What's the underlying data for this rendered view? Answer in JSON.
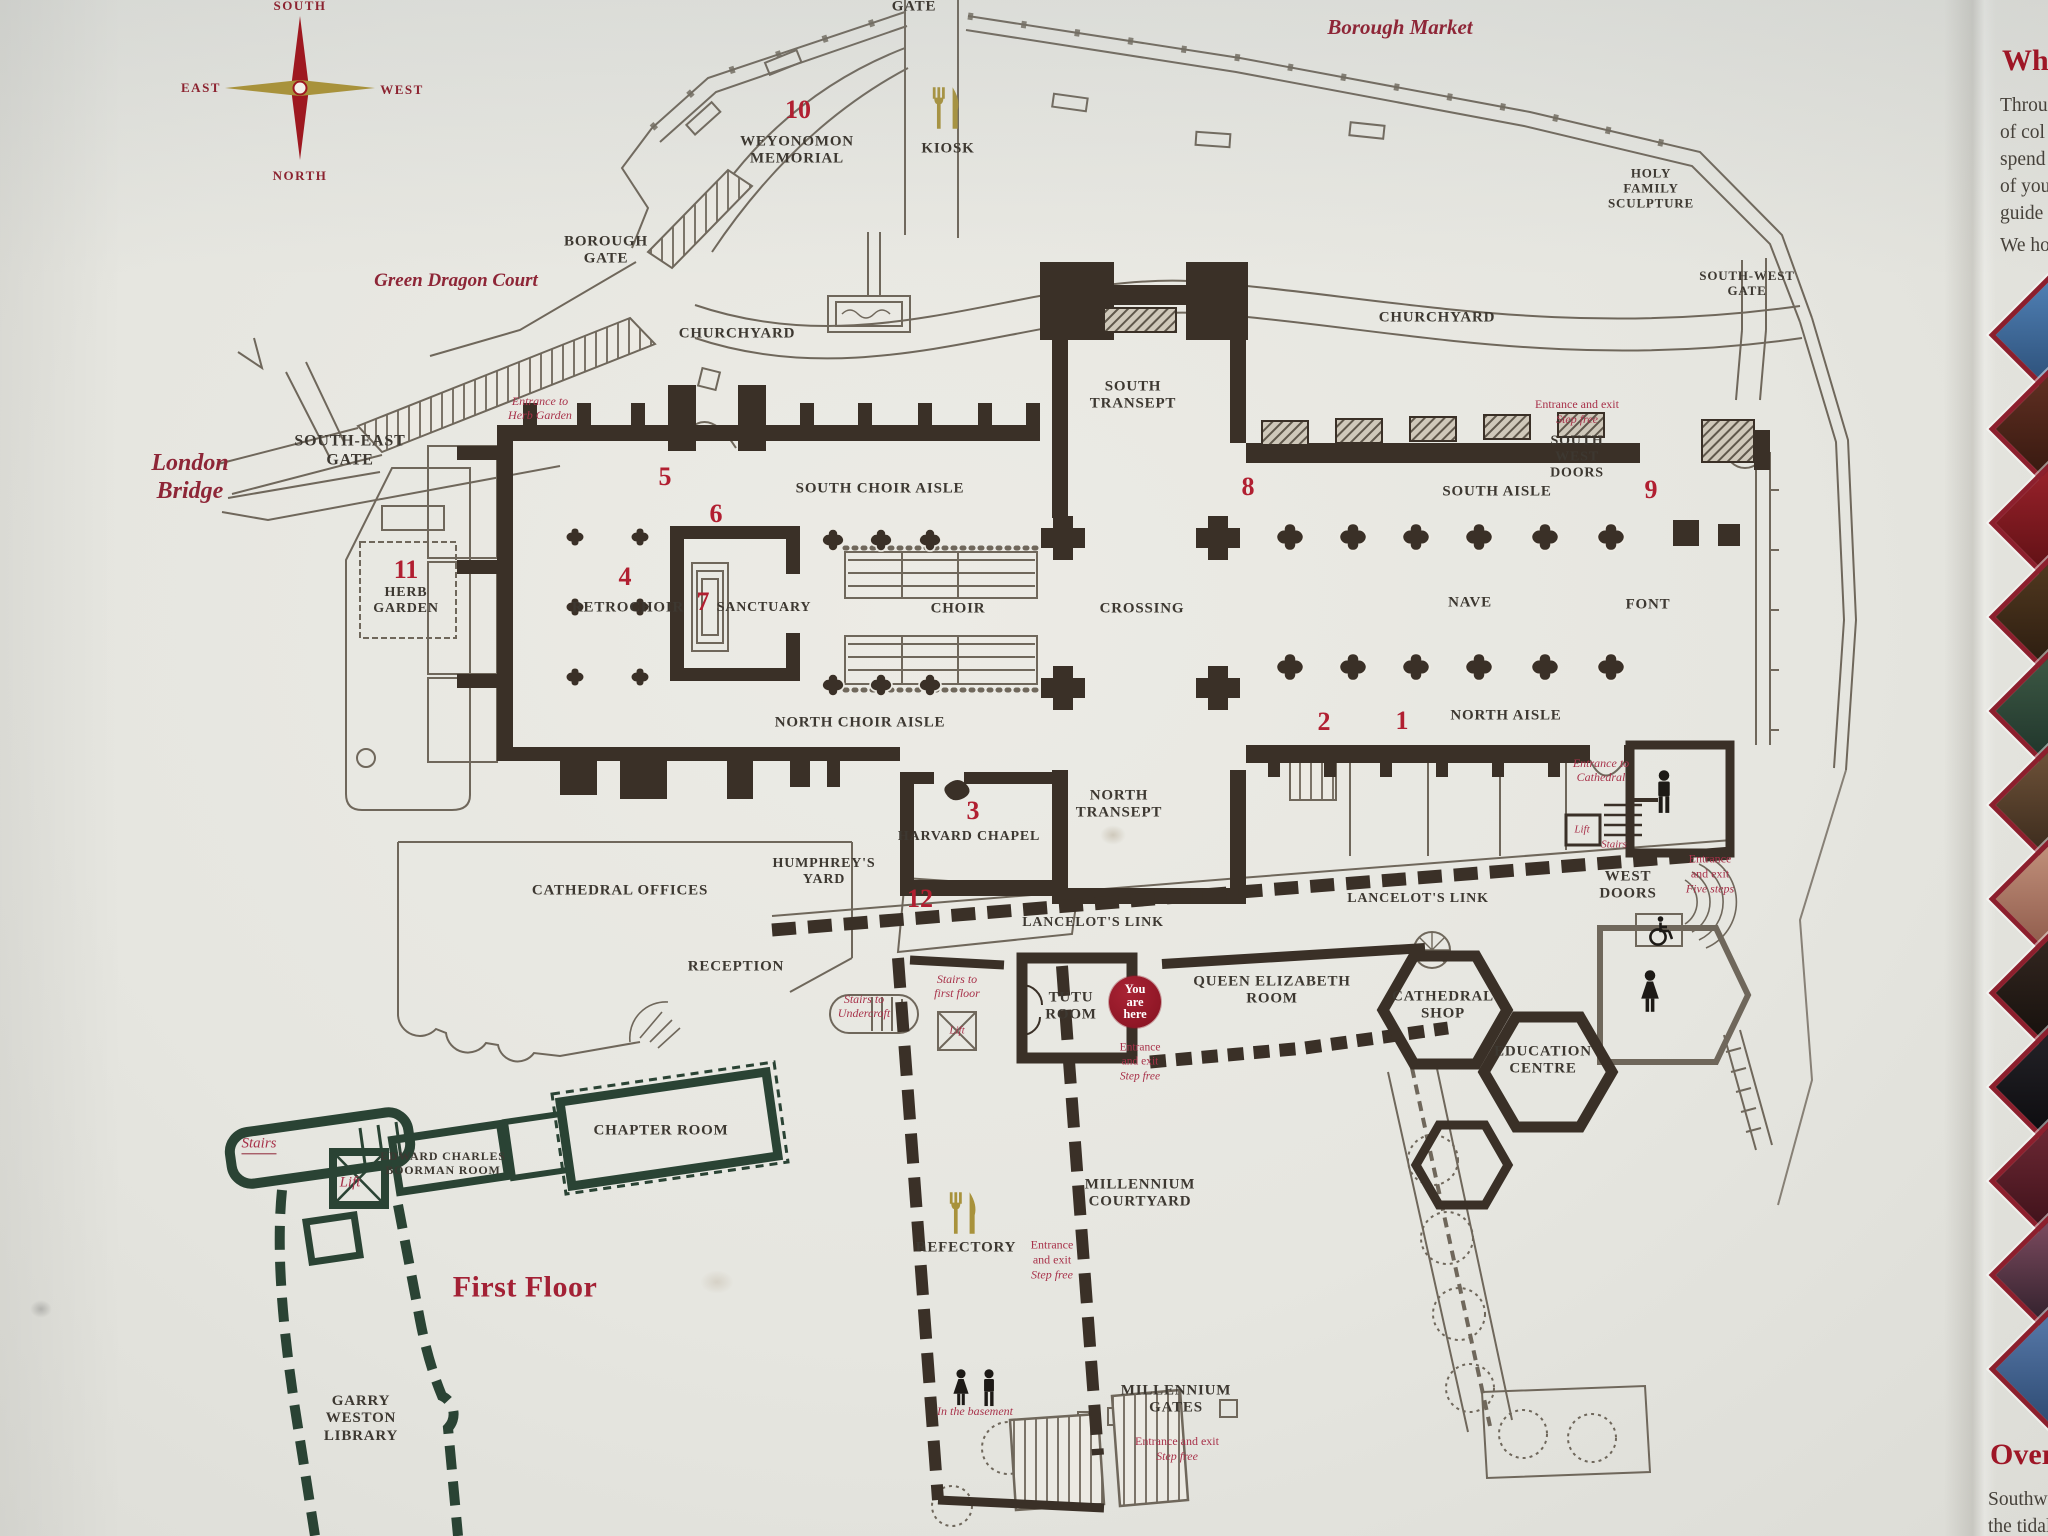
{
  "board_title": "Southwark Cathedral floor plan",
  "compass": {
    "south": "SOUTH",
    "east": "EAST",
    "west": "WEST",
    "north": "NORTH"
  },
  "you_are_here": {
    "l1": "You",
    "l2": "are",
    "l3": "here"
  },
  "colors": {
    "wall": "#3a3027",
    "thin_line": "#6f675b",
    "first_floor_wall": "#2a4334",
    "red_number": "#b11f31",
    "red_note": "#a8324a",
    "maroon_italic": "#8e2637",
    "gold": "#a8923b",
    "you_are_here_red": "#9e1a2b",
    "thumb_border": "#8c1f2d"
  },
  "map": {
    "labels": [
      {
        "id": "gate-label",
        "t": "GATE",
        "x": 914,
        "y": 7,
        "c": "place",
        "s": 15
      },
      {
        "id": "borough-market-label",
        "t": "Borough Market",
        "x": 1400,
        "y": 27,
        "c": "iplace",
        "s": 21
      },
      {
        "id": "num-10",
        "t": "10",
        "x": 798,
        "y": 110,
        "c": "num"
      },
      {
        "id": "weyonomon-memorial-label",
        "t": "WEYONOMON\nMEMORIAL",
        "x": 797,
        "y": 151,
        "c": "place",
        "s": 15
      },
      {
        "id": "kiosk-label",
        "t": "KIOSK",
        "x": 948,
        "y": 149,
        "c": "place",
        "s": 15
      },
      {
        "id": "holy-family-sculpture-label",
        "t": "HOLY\nFAMILY\nSCULPTURE",
        "x": 1651,
        "y": 188,
        "c": "place",
        "s": 13
      },
      {
        "id": "borough-gate-label",
        "t": "BOROUGH\nGATE",
        "x": 606,
        "y": 251,
        "c": "place",
        "s": 15
      },
      {
        "id": "green-dragon-court-label",
        "t": "Green Dragon Court",
        "x": 456,
        "y": 281,
        "c": "iplace",
        "s": 19
      },
      {
        "id": "churchyard-west-label",
        "t": "CHURCHYARD",
        "x": 737,
        "y": 334,
        "c": "place",
        "s": 15
      },
      {
        "id": "churchyard-east-label",
        "t": "CHURCHYARD",
        "x": 1437,
        "y": 318,
        "c": "place",
        "s": 15
      },
      {
        "id": "south-transept-label",
        "t": "SOUTH\nTRANSEPT",
        "x": 1133,
        "y": 396,
        "c": "place",
        "s": 15
      },
      {
        "id": "south-west-gate-label",
        "t": "SOUTH-WEST\nGATE",
        "x": 1747,
        "y": 283,
        "c": "place",
        "s": 13
      },
      {
        "id": "london-bridge-label",
        "t": "London\nBridge",
        "x": 190,
        "y": 478,
        "c": "iplace",
        "s": 24
      },
      {
        "id": "south-east-gate-label",
        "t": "SOUTH-EAST\nGATE",
        "x": 350,
        "y": 451,
        "c": "place",
        "s": 16
      },
      {
        "id": "entrance-herb-garden-note",
        "t": "Entrance to\nHerb Garden",
        "x": 540,
        "y": 409,
        "c": "inote",
        "s": 12
      },
      {
        "id": "num-5",
        "t": "5",
        "x": 665,
        "y": 477,
        "c": "num"
      },
      {
        "id": "south-choir-aisle-label",
        "t": "SOUTH CHOIR AISLE",
        "x": 880,
        "y": 489,
        "c": "place",
        "s": 15
      },
      {
        "id": "num-8",
        "t": "8",
        "x": 1248,
        "y": 487,
        "c": "num"
      },
      {
        "id": "entrance-southwest-note",
        "t": "Entrance and exit\nStep free",
        "x": 1577,
        "y": 412,
        "c": "note",
        "s": 12
      },
      {
        "id": "south-west-doors-label",
        "t": "SOUTH\nWEST\nDOORS",
        "x": 1577,
        "y": 458,
        "c": "place",
        "s": 14
      },
      {
        "id": "south-aisle-label",
        "t": "SOUTH AISLE",
        "x": 1497,
        "y": 492,
        "c": "place",
        "s": 15
      },
      {
        "id": "num-9",
        "t": "9",
        "x": 1651,
        "y": 490,
        "c": "num"
      },
      {
        "id": "num-6",
        "t": "6",
        "x": 716,
        "y": 514,
        "c": "num"
      },
      {
        "id": "num-11",
        "t": "11",
        "x": 406,
        "y": 570,
        "c": "num"
      },
      {
        "id": "herb-garden-label",
        "t": "HERB\nGARDEN",
        "x": 406,
        "y": 601,
        "c": "place",
        "s": 14
      },
      {
        "id": "num-4",
        "t": "4",
        "x": 625,
        "y": 577,
        "c": "num"
      },
      {
        "id": "retrochoir-label",
        "t": "RETROCHOIR",
        "x": 628,
        "y": 608,
        "c": "place",
        "s": 15
      },
      {
        "id": "num-7",
        "t": "7",
        "x": 703,
        "y": 602,
        "c": "num"
      },
      {
        "id": "sanctuary-label",
        "t": "SANCTUARY",
        "x": 764,
        "y": 608,
        "c": "place",
        "s": 14
      },
      {
        "id": "choir-label",
        "t": "CHOIR",
        "x": 958,
        "y": 609,
        "c": "place",
        "s": 15
      },
      {
        "id": "crossing-label",
        "t": "CROSSING",
        "x": 1142,
        "y": 609,
        "c": "place",
        "s": 15
      },
      {
        "id": "nave-label",
        "t": "NAVE",
        "x": 1470,
        "y": 603,
        "c": "place",
        "s": 15
      },
      {
        "id": "font-label",
        "t": "FONT",
        "x": 1648,
        "y": 605,
        "c": "place",
        "s": 15
      },
      {
        "id": "north-choir-aisle-label",
        "t": "NORTH CHOIR AISLE",
        "x": 860,
        "y": 723,
        "c": "place",
        "s": 15
      },
      {
        "id": "num-2",
        "t": "2",
        "x": 1324,
        "y": 722,
        "c": "num"
      },
      {
        "id": "num-1",
        "t": "1",
        "x": 1402,
        "y": 721,
        "c": "num"
      },
      {
        "id": "north-aisle-label",
        "t": "NORTH AISLE",
        "x": 1506,
        "y": 716,
        "c": "place",
        "s": 15
      },
      {
        "id": "entrance-cathedral-note",
        "t": "Entrance to\nCathedral",
        "x": 1601,
        "y": 771,
        "c": "inote",
        "s": 12
      },
      {
        "id": "lift-cathedral-note",
        "t": "Lift",
        "x": 1582,
        "y": 830,
        "c": "inote",
        "s": 11
      },
      {
        "id": "stairs-cathedral-note",
        "t": "Stairs",
        "x": 1614,
        "y": 845,
        "c": "inote",
        "s": 11
      },
      {
        "id": "west-doors-label",
        "t": "WEST\nDOORS",
        "x": 1628,
        "y": 886,
        "c": "place",
        "s": 15
      },
      {
        "id": "entrance-west-note",
        "t": "Entrance\nand exit\nFive steps",
        "x": 1710,
        "y": 874,
        "c": "note",
        "s": 12
      },
      {
        "id": "num-3",
        "t": "3",
        "x": 973,
        "y": 811,
        "c": "num"
      },
      {
        "id": "harvard-chapel-label",
        "t": "HARVARD CHAPEL",
        "x": 969,
        "y": 837,
        "c": "place",
        "s": 14
      },
      {
        "id": "north-transept-label",
        "t": "NORTH\nTRANSEPT",
        "x": 1119,
        "y": 805,
        "c": "place",
        "s": 15
      },
      {
        "id": "cathedral-offices-label",
        "t": "CATHEDRAL OFFICES",
        "x": 620,
        "y": 891,
        "c": "place",
        "s": 15
      },
      {
        "id": "humphreys-yard-label",
        "t": "HUMPHREY'S\nYARD",
        "x": 824,
        "y": 872,
        "c": "place",
        "s": 14
      },
      {
        "id": "num-12",
        "t": "12",
        "x": 920,
        "y": 899,
        "c": "num"
      },
      {
        "id": "lancelots-link-west-label",
        "t": "LANCELOT'S LINK",
        "x": 1093,
        "y": 923,
        "c": "place",
        "s": 14
      },
      {
        "id": "lancelots-link-east-label",
        "t": "LANCELOT'S LINK",
        "x": 1418,
        "y": 899,
        "c": "place",
        "s": 14
      },
      {
        "id": "reception-label",
        "t": "RECEPTION",
        "x": 736,
        "y": 967,
        "c": "place",
        "s": 15
      },
      {
        "id": "stairs-first-floor-note",
        "t": "Stairs to\nfirst floor",
        "x": 957,
        "y": 987,
        "c": "inote",
        "s": 12
      },
      {
        "id": "stairs-undercroft-note",
        "t": "Stairs to\nUndercroft",
        "x": 864,
        "y": 1007,
        "c": "inote",
        "s": 12
      },
      {
        "id": "lift-crossed-note",
        "t": "Lift",
        "x": 957,
        "y": 1031,
        "c": "inote",
        "s": 11
      },
      {
        "id": "tutu-room-label",
        "t": "TUTU\nROOM",
        "x": 1071,
        "y": 1007,
        "c": "place",
        "s": 15
      },
      {
        "id": "queen-elizabeth-room-label",
        "t": "QUEEN ELIZABETH\nROOM",
        "x": 1272,
        "y": 991,
        "c": "place",
        "s": 15
      },
      {
        "id": "entrance-courtyard-note",
        "t": "Entrance\nand exit\nStep free",
        "x": 1140,
        "y": 1062,
        "c": "note",
        "s": 11.5
      },
      {
        "id": "cathedral-shop-label",
        "t": "CATHEDRAL\nSHOP",
        "x": 1443,
        "y": 1006,
        "c": "place",
        "s": 15
      },
      {
        "id": "education-centre-label",
        "t": "EDUCATION\nCENTRE",
        "x": 1543,
        "y": 1061,
        "c": "place",
        "s": 15
      },
      {
        "id": "millennium-courtyard-label",
        "t": "MILLENNIUM\nCOURTYARD",
        "x": 1140,
        "y": 1194,
        "c": "place",
        "s": 15
      },
      {
        "id": "refectory-label",
        "t": "REFECTORY",
        "x": 966,
        "y": 1248,
        "c": "place",
        "s": 15
      },
      {
        "id": "entrance-refectory-note",
        "t": "Entrance\nand exit\nStep free",
        "x": 1052,
        "y": 1260,
        "c": "note",
        "s": 12
      },
      {
        "id": "in-the-basement-note",
        "t": "In the basement",
        "x": 975,
        "y": 1412,
        "c": "inote",
        "s": 12
      },
      {
        "id": "millennium-gates-label",
        "t": "MILLENNIUM\nGATES",
        "x": 1176,
        "y": 1400,
        "c": "place",
        "s": 15
      },
      {
        "id": "entrance-gates-note",
        "t": "Entrance and exit\nStep free",
        "x": 1177,
        "y": 1449,
        "c": "note",
        "s": 12
      },
      {
        "id": "stairs-first-floor-wing-note",
        "t": "Stairs",
        "x": 259,
        "y": 1145,
        "c": "inote",
        "s": 15,
        "u": true
      },
      {
        "id": "lift-first-floor-note",
        "t": "Lift",
        "x": 350,
        "y": 1183,
        "c": "inote",
        "s": 15
      },
      {
        "id": "boorman-room-label",
        "t": "EDWARD CHARLES\nBOORMAN ROOM",
        "x": 443,
        "y": 1164,
        "c": "place",
        "s": 12
      },
      {
        "id": "chapter-room-label",
        "t": "CHAPTER ROOM",
        "x": 661,
        "y": 1131,
        "c": "place",
        "s": 15
      },
      {
        "id": "first-floor-title",
        "t": "First Floor",
        "x": 525,
        "y": 1288,
        "c": "title",
        "s": 30
      },
      {
        "id": "garry-weston-library-label",
        "t": "GARRY\nWESTON\nLIBRARY",
        "x": 361,
        "y": 1419,
        "c": "place",
        "s": 15
      }
    ]
  },
  "sidebar": {
    "heading_top": "Wh",
    "body_top": [
      "Throu",
      "of col",
      "spend",
      "of you",
      "guide"
    ],
    "body_top2": "We ho",
    "heading_bottom": "Over",
    "body_bottom": [
      "Southwa",
      "the tidal"
    ],
    "thumbnails": [
      {
        "name": "thumb-crucifix-blue",
        "c1": "#4f7fb3",
        "c2": "#2c4f78"
      },
      {
        "name": "thumb-figures-brown",
        "c1": "#5f2f22",
        "c2": "#36180f"
      },
      {
        "name": "thumb-banner-red",
        "c1": "#97212a",
        "c2": "#5e1014"
      },
      {
        "name": "thumb-organ-brown",
        "c1": "#50381f",
        "c2": "#2b1c10"
      },
      {
        "name": "thumb-plaque-green",
        "c1": "#3c5844",
        "c2": "#1f342a"
      },
      {
        "name": "thumb-portrait",
        "c1": "#6d5138",
        "c2": "#3a2a1c"
      },
      {
        "name": "thumb-painting-flesh",
        "c1": "#c08f7a",
        "c2": "#8e5a4a"
      },
      {
        "name": "thumb-skull-dark",
        "c1": "#332620",
        "c2": "#15100c"
      },
      {
        "name": "thumb-date-black",
        "c1": "#232227",
        "c2": "#0c0b0e"
      },
      {
        "name": "thumb-fingerprint-red",
        "c1": "#6b2733",
        "c2": "#3d1119"
      },
      {
        "name": "thumb-flower-pink",
        "c1": "#7b4a5e",
        "c2": "#2e1f2a"
      },
      {
        "name": "thumb-porcelain-blue",
        "c1": "#5678a8",
        "c2": "#2f4c74"
      }
    ]
  }
}
